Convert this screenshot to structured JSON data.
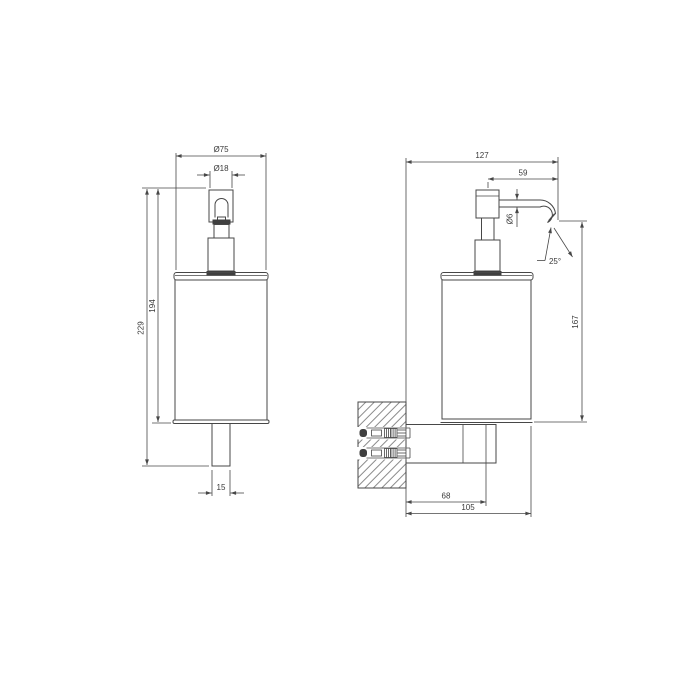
{
  "drawing": {
    "colors": {
      "line": "#474747",
      "text": "#3a3a3a",
      "background": "#ffffff"
    },
    "front_view": {
      "dims": {
        "body_diameter": "Ø75",
        "pump_diameter": "Ø18",
        "total_height": "229",
        "body_height": "194",
        "bracket_width": "15"
      }
    },
    "side_view": {
      "dims": {
        "total_depth": "127",
        "spout_projection": "59",
        "spout_diameter": "Ø6",
        "spout_angle": "25°",
        "spout_to_base_height": "167",
        "wall_to_bracket": "68",
        "wall_to_front": "105"
      }
    }
  }
}
